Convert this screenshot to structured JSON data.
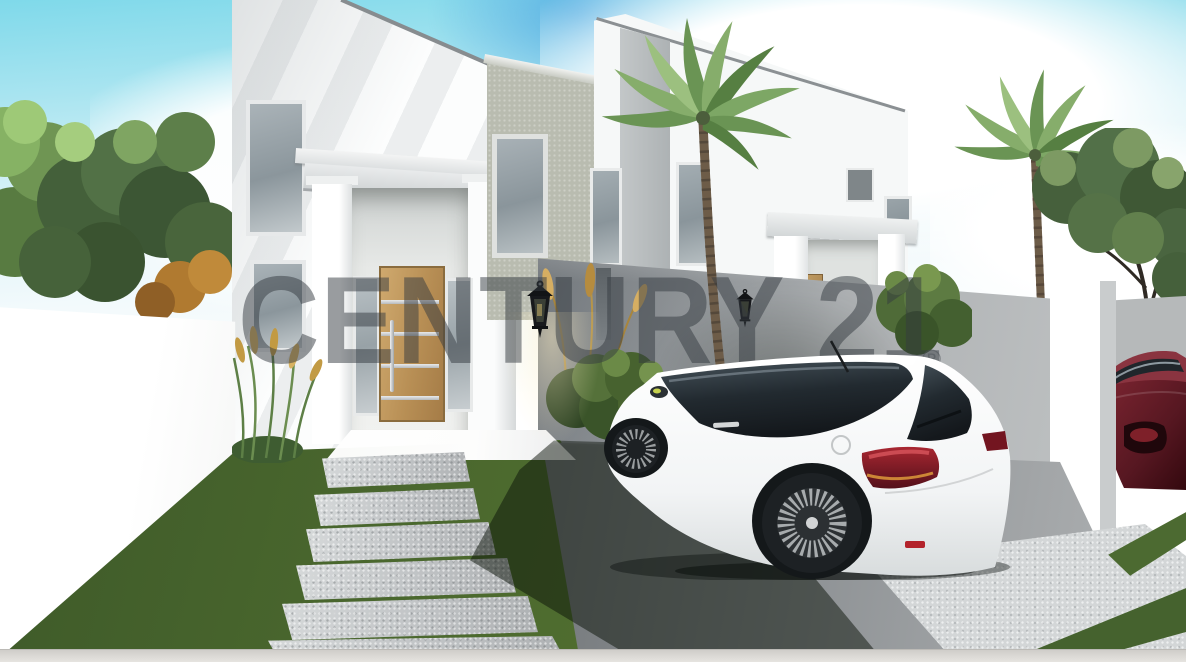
{
  "watermark": {
    "brand": "CENTURY 21",
    "registered_mark": "®"
  },
  "scene": {
    "type": "3D architectural rendering",
    "setting": "Two modern two-storey townhouses with columned entrance porticos, palm trees, white perimeter walls, green lawn with stepping-stone path, and a driveway",
    "objects": [
      "white two-storey house with entrance portico",
      "light oak front door with steel strips",
      "frosted sidelight windows",
      "textured gray side wing with tall window",
      "second townhouse with portico and wooden door",
      "black lantern wall lights",
      "white hatchback car parked on driveway",
      "dark red car behind gate pillar",
      "white gate pillar",
      "gray perimeter fence",
      "palm trees and leafy trees",
      "ornamental grasses and bushes",
      "stepping-stone path across lawn",
      "sunlit concrete pads and grass strips",
      "sidewalk strip"
    ]
  },
  "palette": {
    "sky_blue": "#7fd9ea",
    "cloud_white": "#ffffff",
    "facade_white": "#fcfdfd",
    "fence_gray": "#a1a5a8",
    "wing_beige": "#b9bcb0",
    "door_wood": "#bb9257",
    "lawn_green": "#48652d",
    "stone_gray": "#c6c9cb",
    "car_white": "#f4f6f6",
    "car_red": "#5e1b24",
    "taillight_red": "#8e1b24",
    "watermark_gray": "rgba(52,58,63,0.5)"
  }
}
